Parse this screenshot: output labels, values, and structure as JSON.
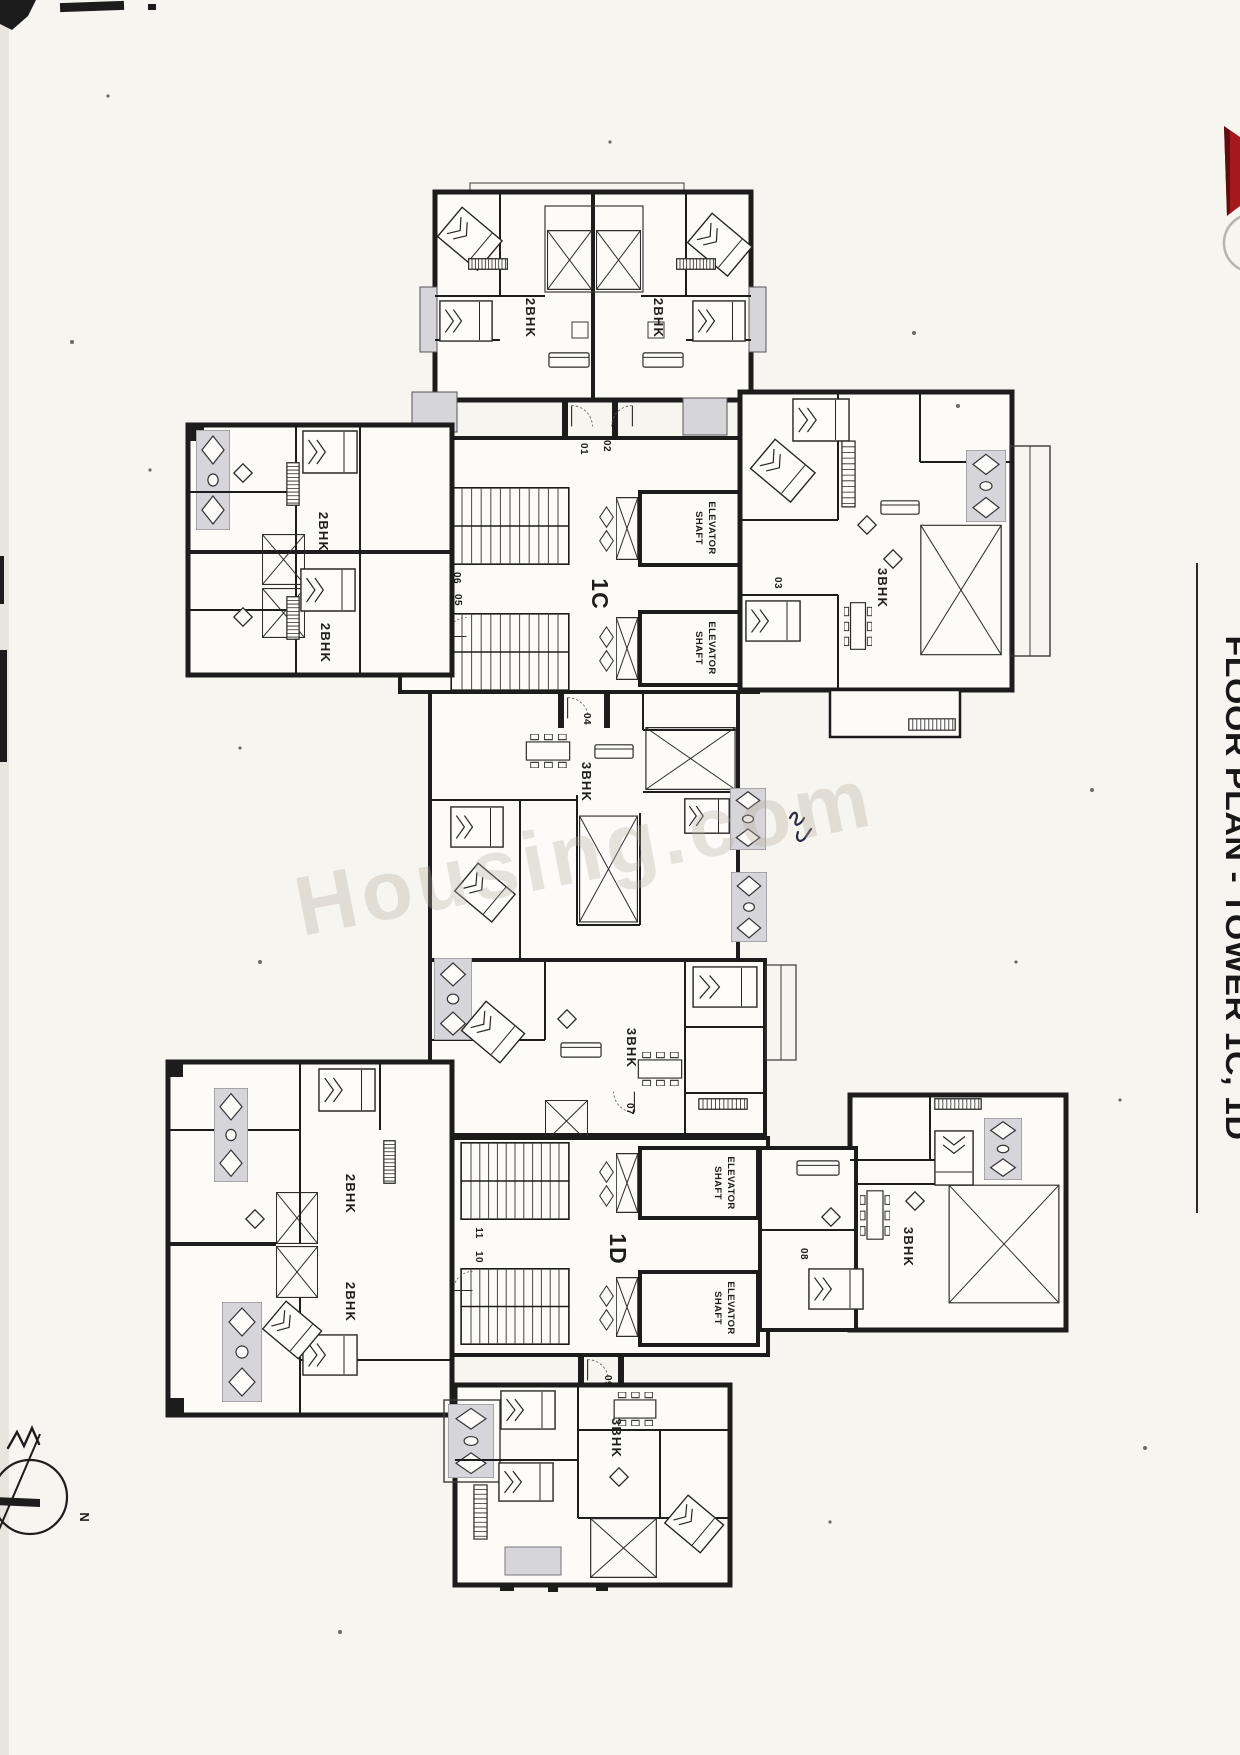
{
  "header": {
    "title": "FLOOR PLAN - TOWER 1C, 1D"
  },
  "watermark": {
    "text": "Housing.com"
  },
  "compass": {
    "north": "N"
  },
  "plan": {
    "cores": [
      {
        "name": "1C"
      },
      {
        "name": "1D"
      }
    ],
    "elevator_shaft": {
      "line1": "ELEVATOR",
      "line2": "SHAFT"
    },
    "units": [
      {
        "number": "01",
        "type": "2BHK"
      },
      {
        "number": "02",
        "type": "2BHK"
      },
      {
        "number": "03",
        "type": "3BHK"
      },
      {
        "number": "04",
        "type": "3BHK"
      },
      {
        "number": "05",
        "type": "2BHK"
      },
      {
        "number": "06",
        "type": "2BHK"
      },
      {
        "number": "07",
        "type": "3BHK"
      },
      {
        "number": "08",
        "type": "3BHK"
      },
      {
        "number": "09",
        "type": "3BHK"
      },
      {
        "number": "10",
        "type": "2BHK"
      },
      {
        "number": "11",
        "type": "2BHK"
      }
    ]
  },
  "colors": {
    "ink": "#1d1d1d",
    "paper": "#f7f5f0",
    "deck_gray": "#d6d6da",
    "logo_red": "#a5181c",
    "watermark_gray": "#b6ac9f"
  }
}
